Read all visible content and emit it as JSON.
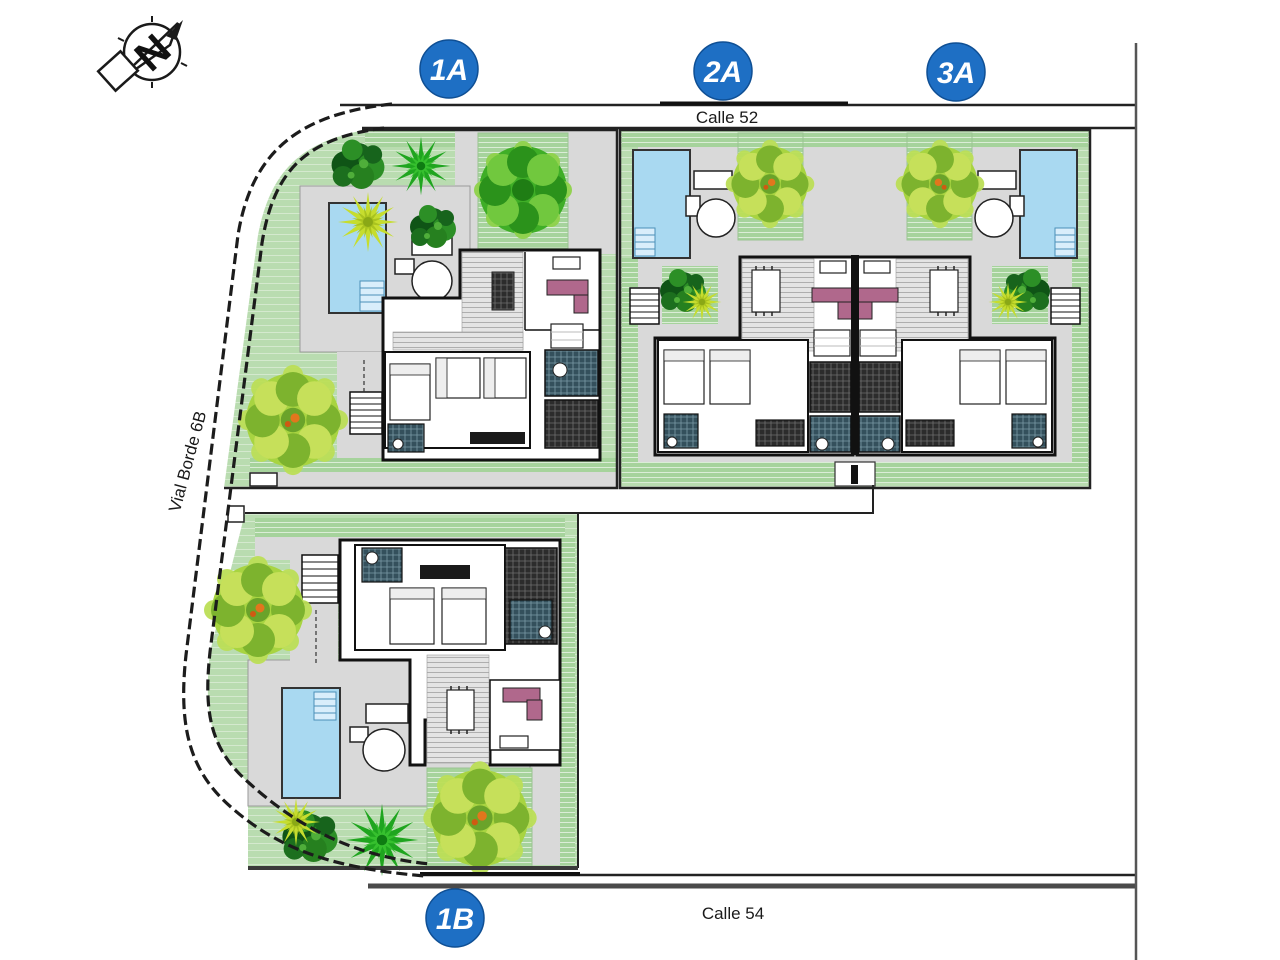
{
  "canvas": {
    "width": 1280,
    "height": 960,
    "background": "#ffffff"
  },
  "compass": {
    "icon": "north-arrow-icon",
    "letter": "N"
  },
  "streets": {
    "top": {
      "label": "Calle 52"
    },
    "bottom": {
      "label": "Calle 54"
    },
    "west": {
      "label": "Vial Borde 6B"
    }
  },
  "units": [
    {
      "id": "unit-1a",
      "label": "1A"
    },
    {
      "id": "unit-2a",
      "label": "2A"
    },
    {
      "id": "unit-3a",
      "label": "3A"
    },
    {
      "id": "unit-1b",
      "label": "1B"
    }
  ],
  "colors": {
    "badge_blue": "#1e6fc4",
    "badge_edge": "#0f4f94",
    "lawn": "#b9dcb0",
    "lawn_hatch": "#a6d39c",
    "deck": "#d9d9d9",
    "pool": "#a9d9f1",
    "pool_steps": "#d9eefb",
    "tree_dark": "#1d7a22",
    "tree_light": "#a8d441",
    "palm_yellow": "#c6dd2e",
    "palm_green": "#1fa51f",
    "sofa_mauve": "#b0688c",
    "wall": "#111111",
    "road_line": "#222222"
  }
}
